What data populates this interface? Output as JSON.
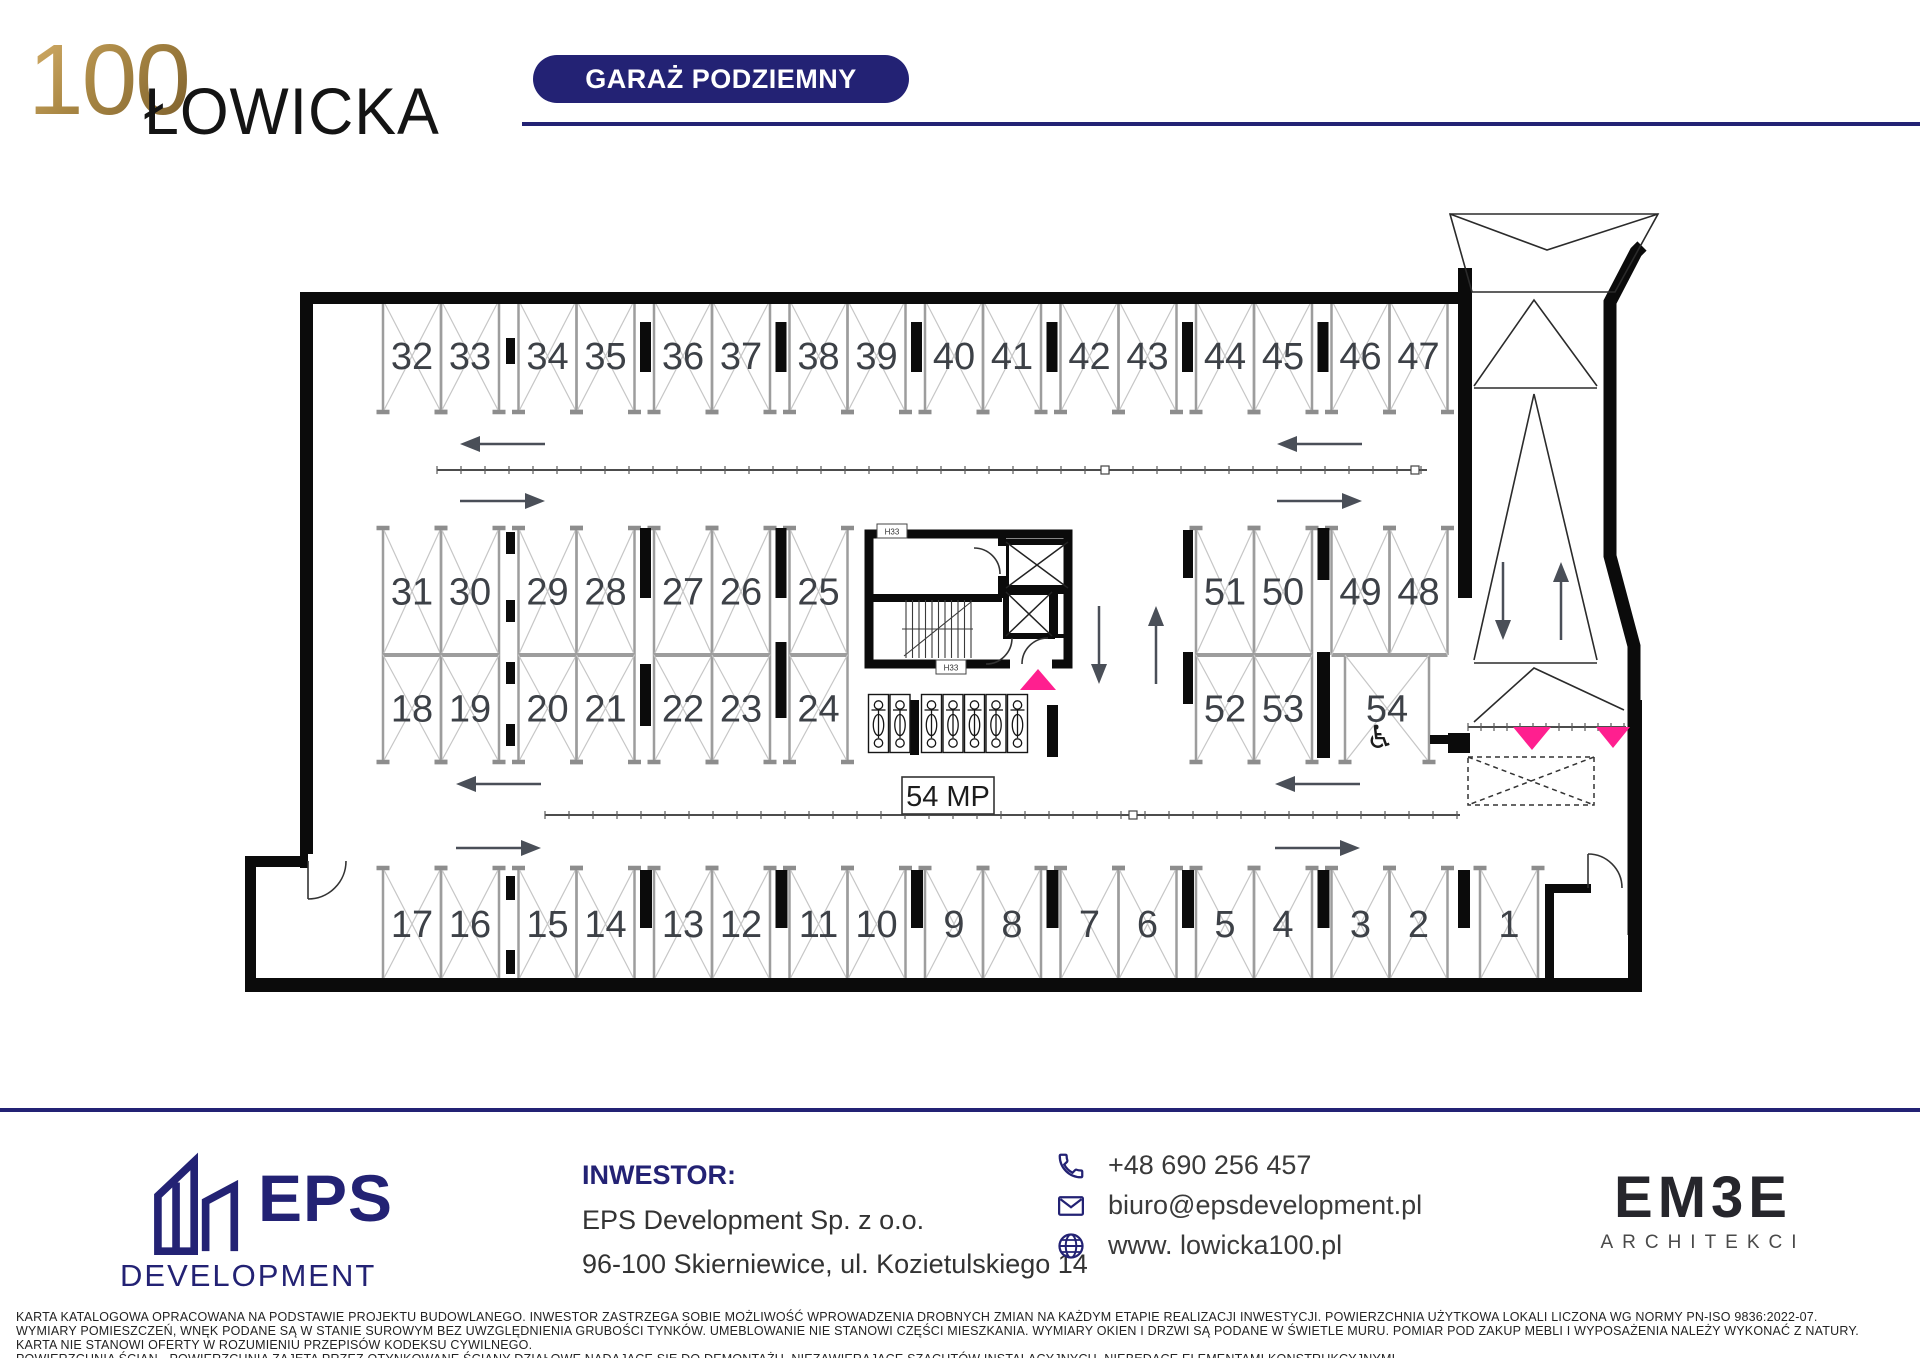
{
  "header": {
    "logo_number": "100",
    "logo_name": "ŁOWICKA",
    "badge": "GARAŻ PODZIEMNY"
  },
  "plan": {
    "capacity_label": "54 MP",
    "accessible_symbol": "♿",
    "core_labels": [
      "H33",
      "H33"
    ],
    "rows": [
      {
        "y": 300,
        "h": 112,
        "open": "bottom",
        "groups": [
          {
            "x": 383,
            "stalls": [
              "32",
              "33"
            ]
          },
          {
            "x": 518.5,
            "stalls": [
              "34",
              "35"
            ]
          },
          {
            "x": 654,
            "stalls": [
              "36",
              "37"
            ]
          },
          {
            "x": 789.5,
            "stalls": [
              "38",
              "39"
            ]
          },
          {
            "x": 925,
            "stalls": [
              "40",
              "41"
            ]
          },
          {
            "x": 1060.5,
            "stalls": [
              "42",
              "43"
            ]
          },
          {
            "x": 1196,
            "stalls": [
              "44",
              "45"
            ]
          },
          {
            "x": 1331.5,
            "stalls": [
              "46",
              "47"
            ]
          }
        ]
      },
      {
        "y": 528,
        "h": 127,
        "open": "top",
        "groups": [
          {
            "x": 383,
            "stalls": [
              "31",
              "30"
            ]
          },
          {
            "x": 518.5,
            "stalls": [
              "29",
              "28"
            ]
          },
          {
            "x": 654,
            "stalls": [
              "27",
              "26"
            ]
          },
          {
            "x": 789.5,
            "stalls": [
              "25"
            ]
          },
          {
            "x": 1196,
            "stalls": [
              "51",
              "50"
            ]
          },
          {
            "x": 1331.5,
            "stalls": [
              "49",
              "48"
            ]
          }
        ]
      },
      {
        "y": 655,
        "h": 107,
        "open": "bottom",
        "groups": [
          {
            "x": 383,
            "stalls": [
              "18",
              "19"
            ]
          },
          {
            "x": 518.5,
            "stalls": [
              "20",
              "21"
            ]
          },
          {
            "x": 654,
            "stalls": [
              "22",
              "23"
            ]
          },
          {
            "x": 789.5,
            "stalls": [
              "24"
            ]
          },
          {
            "x": 1196,
            "stalls": [
              "52",
              "53"
            ]
          },
          {
            "x": 1345,
            "w": 84,
            "stalls": [
              "54"
            ]
          }
        ]
      },
      {
        "y": 868,
        "h": 112,
        "open": "top",
        "groups": [
          {
            "x": 383,
            "stalls": [
              "17",
              "16"
            ]
          },
          {
            "x": 518.5,
            "stalls": [
              "15",
              "14"
            ]
          },
          {
            "x": 654,
            "stalls": [
              "13",
              "12"
            ]
          },
          {
            "x": 789.5,
            "stalls": [
              "11",
              "10"
            ]
          },
          {
            "x": 925,
            "stalls": [
              "9",
              "8"
            ]
          },
          {
            "x": 1060.5,
            "stalls": [
              "7",
              "6"
            ]
          },
          {
            "x": 1196,
            "stalls": [
              "5",
              "4"
            ]
          },
          {
            "x": 1331.5,
            "stalls": [
              "3",
              "2"
            ]
          },
          {
            "x": 1480,
            "stalls": [
              "1"
            ]
          }
        ]
      }
    ],
    "pillars": [
      [
        506,
        338,
        9,
        26
      ],
      [
        640,
        322,
        11,
        50
      ],
      [
        775.5,
        322,
        11,
        50
      ],
      [
        911,
        322,
        11,
        50
      ],
      [
        1046.5,
        322,
        11,
        50
      ],
      [
        1182,
        322,
        11,
        50
      ],
      [
        1317.5,
        322,
        11,
        50
      ],
      [
        506,
        532,
        9,
        22
      ],
      [
        506,
        600,
        9,
        22
      ],
      [
        640,
        528,
        11,
        70
      ],
      [
        775.5,
        528,
        11,
        70
      ],
      [
        1183,
        530,
        10,
        48
      ],
      [
        1317.5,
        528,
        12,
        52
      ],
      [
        506,
        662,
        9,
        22
      ],
      [
        506,
        724,
        9,
        22
      ],
      [
        640,
        664,
        11,
        62
      ],
      [
        775.5,
        642,
        11,
        76
      ],
      [
        1183,
        652,
        10,
        52
      ],
      [
        1317,
        652,
        13,
        106
      ],
      [
        910,
        700,
        9,
        55
      ],
      [
        1047,
        705,
        11,
        52
      ],
      [
        506,
        876,
        9,
        24
      ],
      [
        506,
        950,
        9,
        24
      ],
      [
        640,
        870,
        12,
        58
      ],
      [
        775.5,
        870,
        12,
        58
      ],
      [
        911,
        870,
        12,
        58
      ],
      [
        1046.5,
        870,
        12,
        58
      ],
      [
        1182,
        870,
        12,
        58
      ],
      [
        1317.5,
        870,
        12,
        58
      ],
      [
        1458,
        870,
        12,
        58
      ]
    ],
    "channels": [
      {
        "x1": 437,
        "x2": 1427,
        "y": 470,
        "step": 24,
        "squares": [
          1105,
          1415
        ]
      },
      {
        "x1": 545,
        "x2": 1460,
        "y": 815,
        "step": 24,
        "squares": [
          1133
        ]
      },
      {
        "x1": 1468,
        "x2": 1626,
        "y": 727,
        "step": 13,
        "squares": []
      }
    ],
    "arrows": [
      [
        545,
        444,
        460,
        444
      ],
      [
        460,
        501,
        545,
        501
      ],
      [
        1362,
        444,
        1277,
        444
      ],
      [
        1277,
        501,
        1362,
        501
      ],
      [
        541,
        784,
        456,
        784
      ],
      [
        456,
        848,
        541,
        848
      ],
      [
        1360,
        784,
        1275,
        784
      ],
      [
        1275,
        848,
        1360,
        848
      ],
      [
        1099,
        606,
        1099,
        684
      ],
      [
        1156,
        684,
        1156,
        606
      ],
      [
        1503,
        562,
        1503,
        640
      ],
      [
        1561,
        640,
        1561,
        562
      ]
    ],
    "bike_rack": {
      "x": 868,
      "y": 694,
      "count": 7,
      "stall_w": 21.5,
      "pillar_after": 2,
      "pillar_gap": 10
    }
  },
  "footer": {
    "eps_name": "EPS",
    "eps_sub": "DEVELOPMENT",
    "investor_heading": "INWESTOR:",
    "investor_name": "EPS Development Sp. z o.o.",
    "investor_address": "96-100 Skierniewice, ul. Kozietulskiego 14",
    "phone": "+48 690 256 457",
    "email": "biuro@epsdevelopment.pl",
    "website": "www. lowicka100.pl",
    "architect_name": "EM3E",
    "architect_sub": "ARCHITEKCI"
  },
  "disclaimer": [
    "KARTA KATALOGOWA OPRACOWANA NA PODSTAWIE PROJEKTU BUDOWLANEGO. INWESTOR ZASTRZEGA SOBIE MOŻLIWOŚĆ WPROWADZENIA DROBNYCH ZMIAN NA KAŻDYM ETAPIE REALIZACJI INWESTYCJI. POWIERZCHNIA UŻYTKOWA LOKALI LICZONA WG NORMY PN-ISO 9836:2022-07.",
    "WYMIARY POMIESZCZEŃ, WNĘK PODANE SĄ W STANIE SUROWYM BEZ UWZGLĘDNIENIA GRUBOŚCI TYNKÓW. UMEBLOWANIE NIE STANOWI CZĘŚCI MIESZKANIA. WYMIARY OKIEN I DRZWI SĄ PODANE W ŚWIETLE MURU. POMIAR POD ZAKUP MEBLI I WYPOSAŻENIA NALEŻY WYKONAĆ Z NATURY.",
    "KARTA NIE STANOWI OFERTY W ROZUMIENIU PRZEPISÓW KODEKSU CYWILNEGO.",
    "POWIERZCHNIA ŚCIAN - POWIERZCHNIA ZAJĘTA PRZEZ OTYNKOWANE ŚCIANY DZIAŁOWE NADAJĄCE SIĘ DO DEMONTAŻU, NIEZAWIERAJĄCE SZACHTÓW INSTALACYJNYCH, NIEBĘDĄCE ELEMENTAMI KONSTRUKCYJNYMI."
  ]
}
